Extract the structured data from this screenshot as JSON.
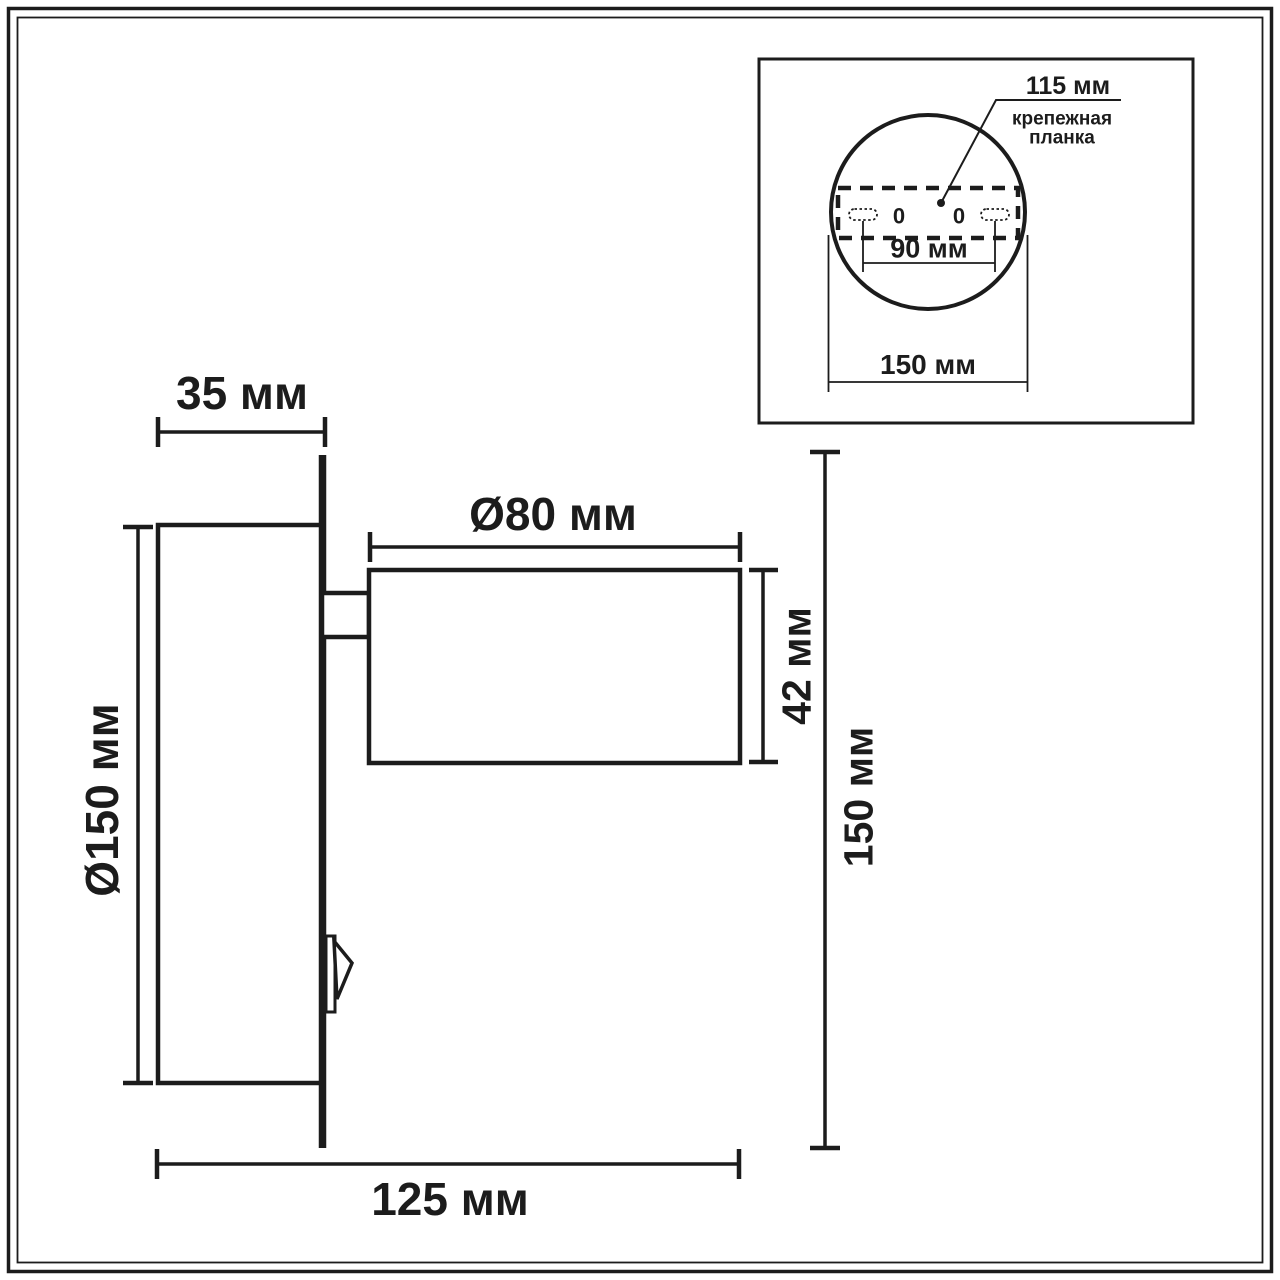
{
  "drawing": {
    "side_view": {
      "plate_depth": "35 мм",
      "spot_diameter": "Ø80 мм",
      "plate_diameter": "Ø150 мм",
      "spot_height": "42 мм",
      "overall_height": "150 мм",
      "overall_depth": "125 мм"
    },
    "inset": {
      "bracket_width": "115 мм",
      "bracket_label_line1": "крепежная",
      "bracket_label_line2": "планка",
      "holes_distance": "90 мм",
      "base_diameter": "150 мм",
      "hole_left_mark": "0",
      "hole_right_mark": "0"
    },
    "colors": {
      "line": "#1c1c1c",
      "background": "#ffffff"
    }
  }
}
